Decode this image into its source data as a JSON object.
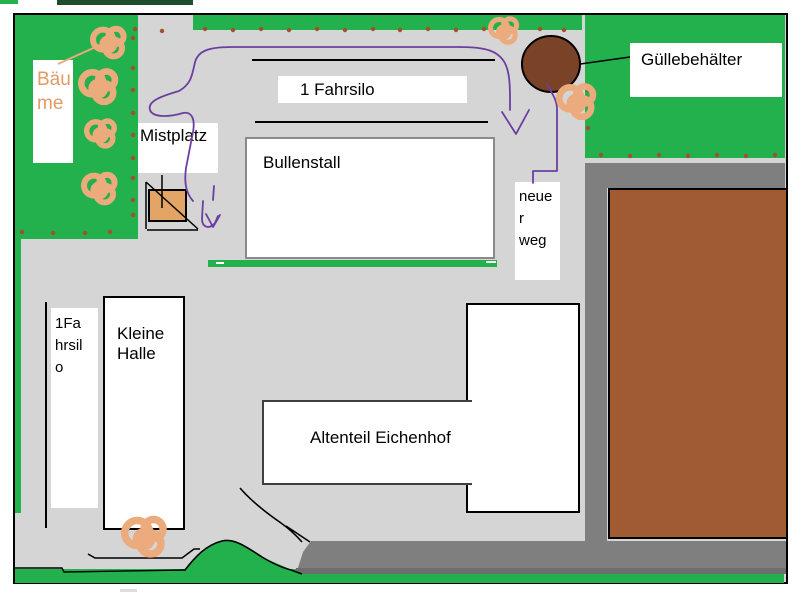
{
  "map": {
    "region_labels": {
      "baeume": "Bäu\nme",
      "fahrsilo_top": "1 Fahrsilo",
      "mistplatz": "Mistplatz",
      "bullenstall": "Bullenstall",
      "guellebehaelter": "Güllebehälter",
      "neuer_weg": "neue\nr\nweg",
      "fahrsilo_left": "1Fa\nhrsil\no",
      "kleine_halle": "Kleine\nHalle",
      "altenteil": "Altenteil Eichenhof"
    }
  },
  "colors": {
    "grass_green": "#22B14C",
    "yard_gray": "#D5D5D5",
    "road_gray": "#7F7F7F",
    "field_brown": "#A15B33",
    "tank_brown": "#7A4226",
    "tree_tan": "#ECAB7C",
    "path_purple": "#6B3FA0",
    "dot_brown": "#A0502F",
    "baeume_text_orange": "#E39A66"
  },
  "decorations": {
    "dots": [
      [
        133,
        38
      ],
      [
        133,
        68
      ],
      [
        133,
        90
      ],
      [
        133,
        113
      ],
      [
        133,
        135
      ],
      [
        133,
        158
      ],
      [
        133,
        178
      ],
      [
        133,
        200
      ],
      [
        133,
        215
      ],
      [
        22,
        232
      ],
      [
        53,
        233
      ],
      [
        85,
        233
      ],
      [
        110,
        232
      ],
      [
        135,
        29
      ],
      [
        162,
        31
      ],
      [
        205,
        29
      ],
      [
        233,
        30
      ],
      [
        261,
        29
      ],
      [
        289,
        30
      ],
      [
        317,
        29
      ],
      [
        345,
        30
      ],
      [
        373,
        29
      ],
      [
        400,
        30
      ],
      [
        428,
        29
      ],
      [
        456,
        30
      ],
      [
        484,
        29
      ],
      [
        512,
        30
      ],
      [
        540,
        29
      ],
      [
        564,
        30
      ],
      [
        588,
        90
      ],
      [
        588,
        128
      ],
      [
        601,
        155
      ],
      [
        630,
        156
      ],
      [
        659,
        155
      ],
      [
        688,
        156
      ],
      [
        717,
        155
      ],
      [
        746,
        156
      ],
      [
        775,
        155
      ]
    ],
    "trees": [
      {
        "x": 110,
        "y": 42,
        "r": 20
      },
      {
        "x": 100,
        "y": 86,
        "r": 22
      },
      {
        "x": 102,
        "y": 133,
        "r": 18
      },
      {
        "x": 101,
        "y": 188,
        "r": 20
      },
      {
        "x": 505,
        "y": 30,
        "r": 17
      },
      {
        "x": 578,
        "y": 101,
        "r": 22
      },
      {
        "x": 146,
        "y": 536,
        "r": 25
      }
    ]
  }
}
